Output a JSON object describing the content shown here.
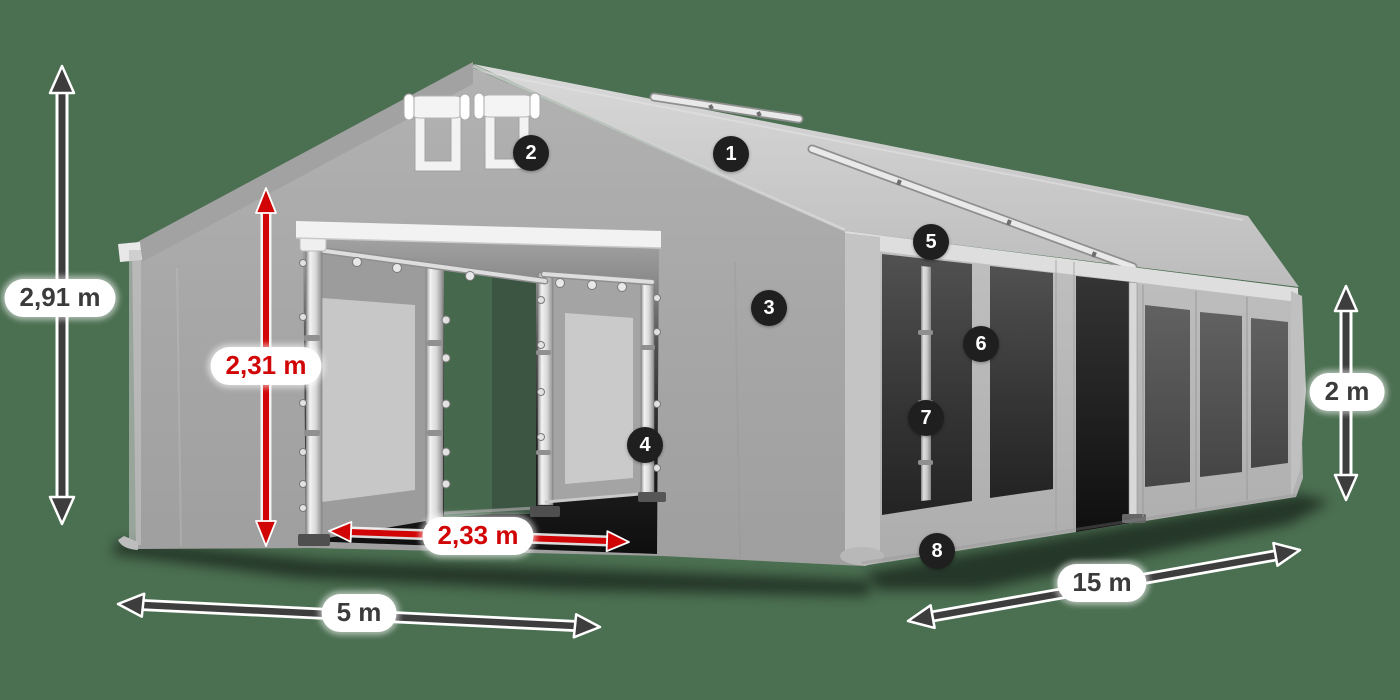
{
  "diagram": {
    "dimensions": {
      "total_height": "2,91 m",
      "entrance_height": "2,31 m",
      "entrance_width": "2,33 m",
      "front_width": "5 m",
      "side_length": "15 m",
      "side_height": "2 m"
    },
    "markers": [
      "1",
      "2",
      "3",
      "4",
      "5",
      "6",
      "7",
      "8"
    ],
    "colors": {
      "background": "#4b6f51",
      "dimension_red": "#d10505",
      "dimension_dark": "#3d3d3d",
      "label_bg": "#ffffff",
      "label_text": "#3b3b3b",
      "marker_bg": "#1f1f1f",
      "marker_text": "#ffffff",
      "tent_roof": "#cccccc",
      "tent_wall": "#a8a8a8",
      "tent_side_wall": "#b5b5b5",
      "tent_trim": "#f2f2f2",
      "opening_dark": "#2a2a2a"
    }
  }
}
